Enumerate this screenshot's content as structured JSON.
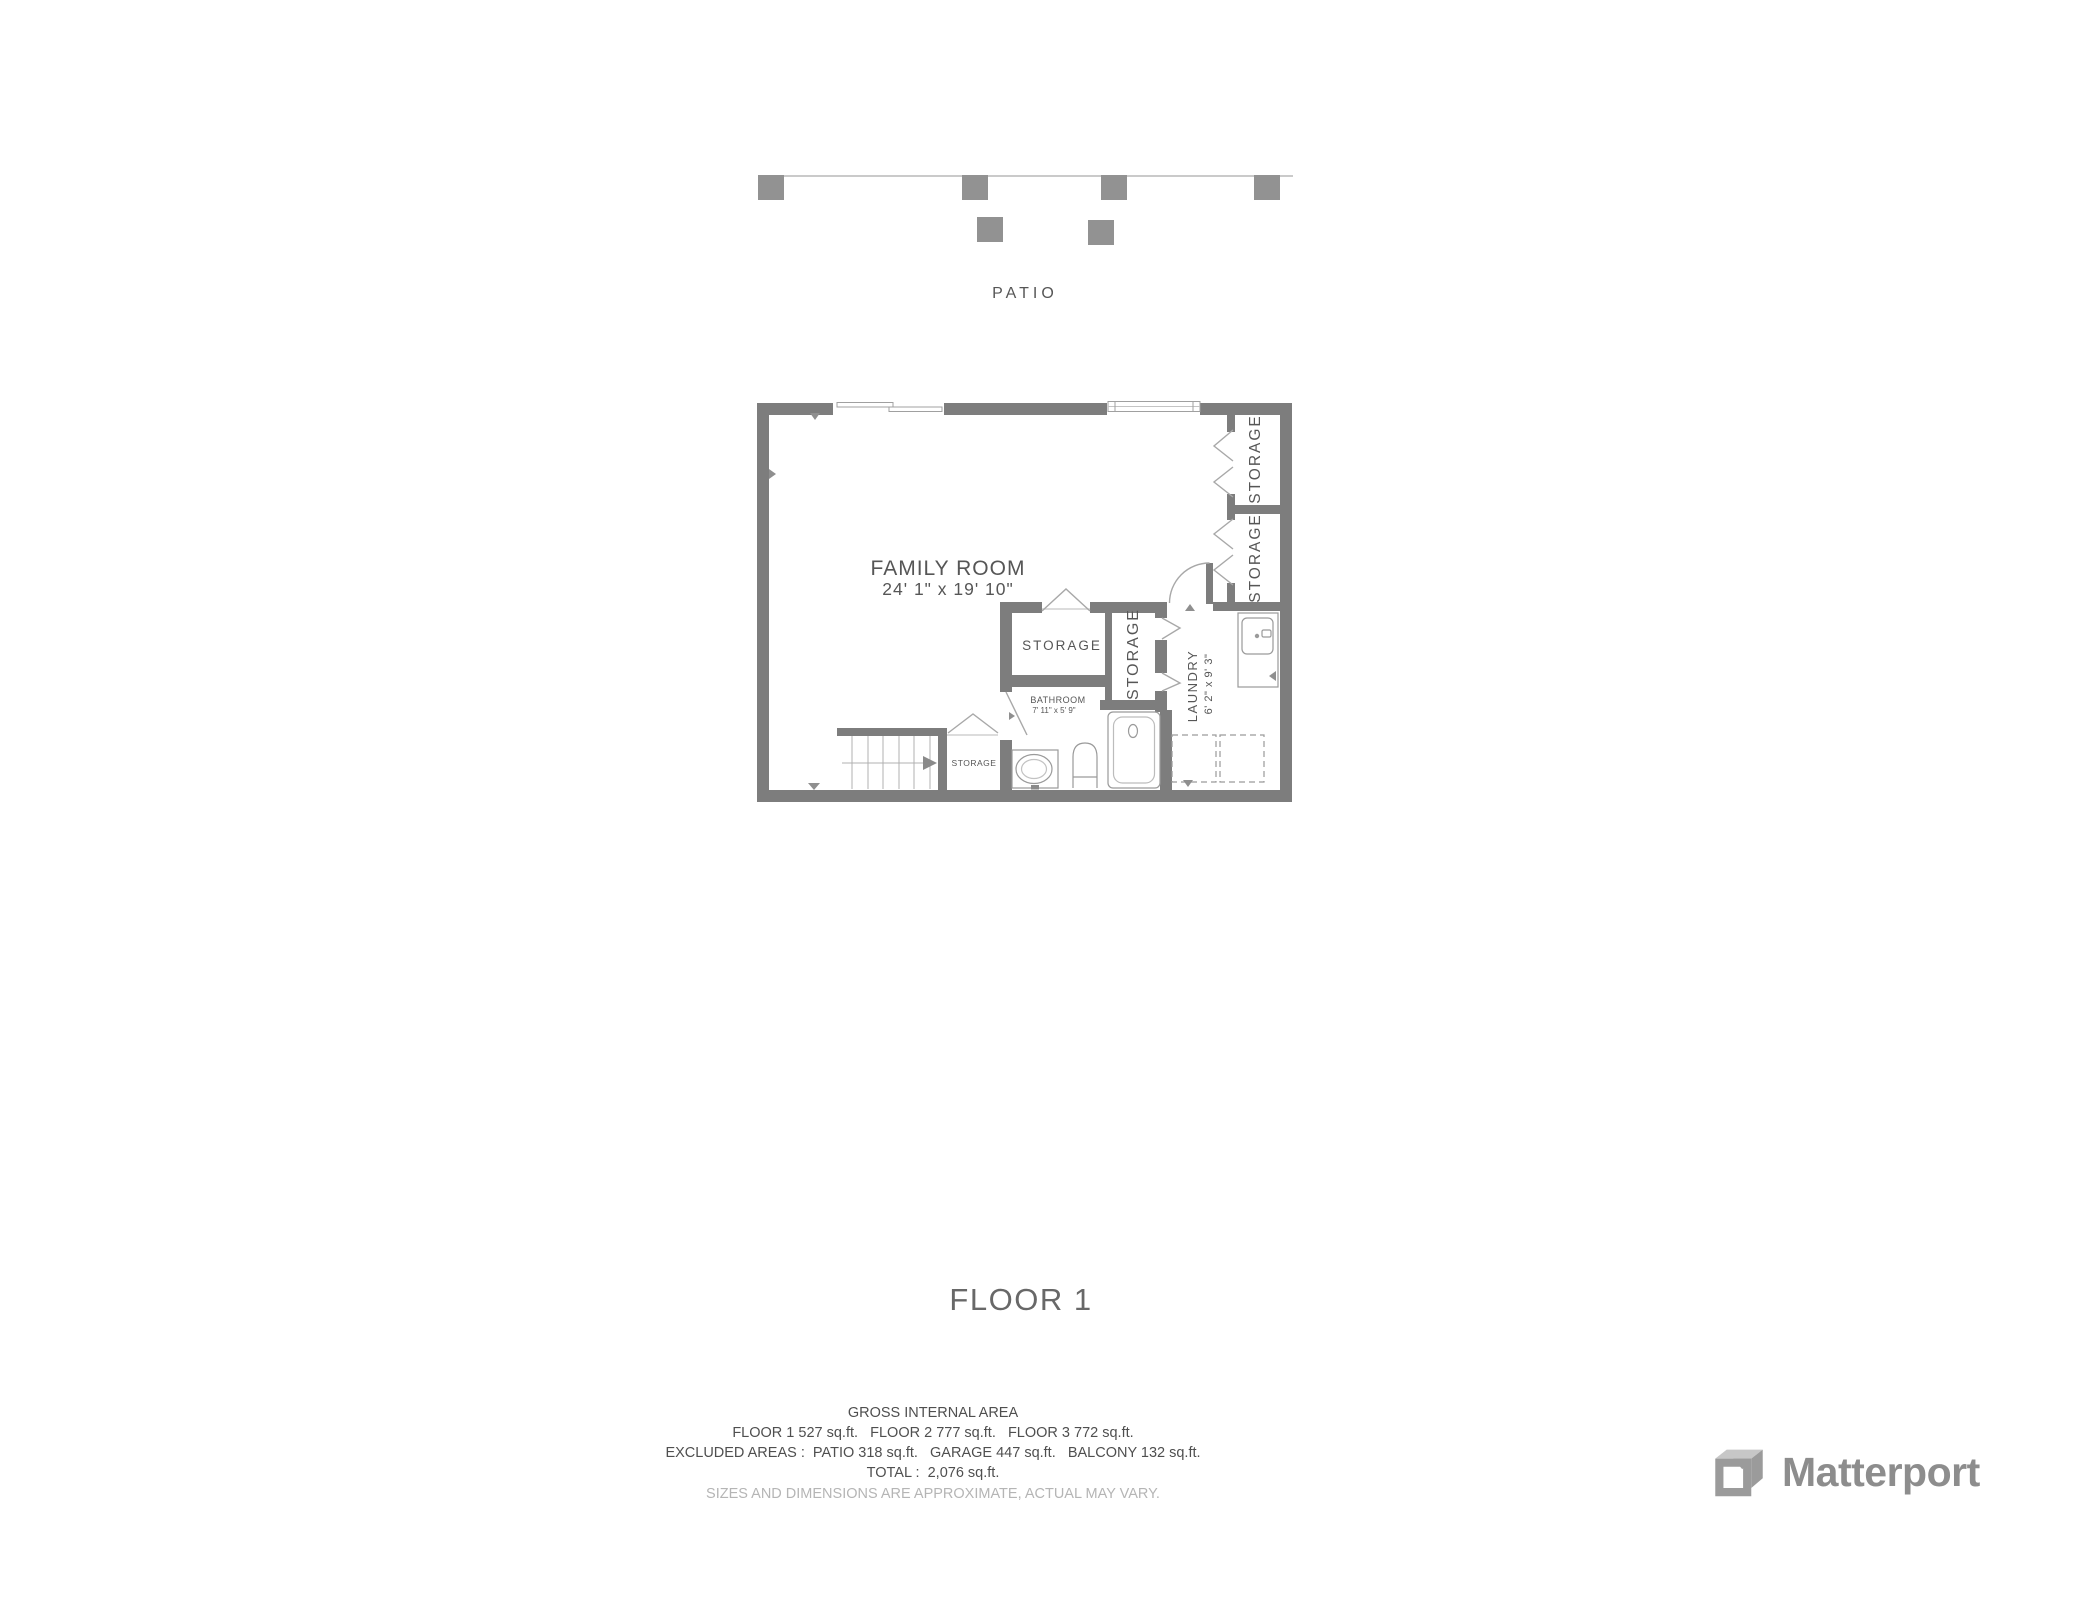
{
  "patio": {
    "label": "PATIO"
  },
  "floor_plan": {
    "family_room": {
      "name": "FAMILY ROOM",
      "dims": "24' 1\" x 19' 10\""
    },
    "bathroom": {
      "name": "BATHROOM",
      "dims": "7' 11\" x 5' 9\""
    },
    "laundry": {
      "name": "LAUNDRY",
      "dims": "6' 2\" x 9' 3\""
    },
    "storage_top_right_1": {
      "name": "STORAGE"
    },
    "storage_top_right_2": {
      "name": "STORAGE"
    },
    "storage_hall": {
      "name": "STORAGE"
    },
    "storage_closet": {
      "name": "STORAGE"
    },
    "storage_under_stairs": {
      "name": "STORAGE"
    }
  },
  "title": {
    "label": "FLOOR 1"
  },
  "area_summary": {
    "heading": "GROSS INTERNAL AREA",
    "floors_line": "FLOOR 1 527 sq.ft.   FLOOR 2 777 sq.ft.   FLOOR 3 772 sq.ft.",
    "excluded_line": "EXCLUDED AREAS :  PATIO 318 sq.ft.   GARAGE 447 sq.ft.   BALCONY 132 sq.ft.",
    "total_line": "TOTAL :  2,076 sq.ft.",
    "disclaimer": "SIZES AND DIMENSIONS ARE APPROXIMATE, ACTUAL MAY VARY."
  },
  "branding": {
    "wordmark": "Matterport"
  },
  "colors": {
    "wall": "#7d7d7d",
    "post": "#929292",
    "thin_line": "#b8b8b8",
    "fixture_line": "#9a9a9a",
    "label_text": "#565656",
    "title_text": "#686868",
    "summary_text": "#4f4f4f",
    "disclaimer_text": "#b5b5b5",
    "logo": "#8d8d8d"
  }
}
